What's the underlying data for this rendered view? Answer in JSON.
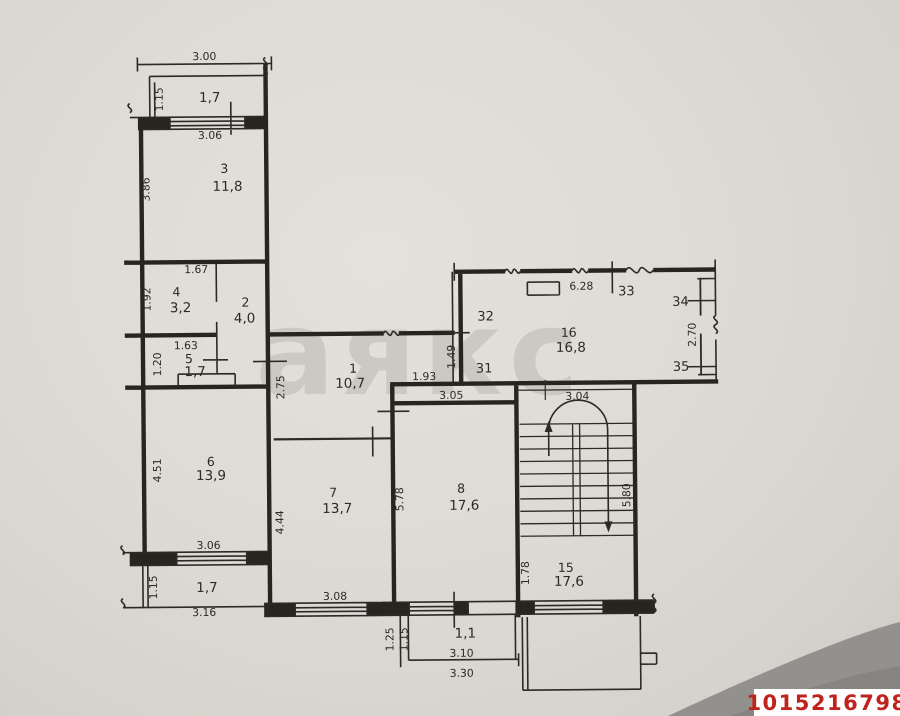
{
  "watermark": "аякс",
  "photo_id": "1015216798",
  "colors": {
    "paper": "#dedbd6",
    "ink": "#2b2a26",
    "id_red": "#c0221c",
    "shadow": "#8f8d8a",
    "watermark": "#ccc8c2"
  },
  "rooms": {
    "r1": {
      "num": "1",
      "area": "10,7"
    },
    "r2": {
      "num": "2",
      "area": "4,0"
    },
    "r3": {
      "num": "3",
      "area": "11,8"
    },
    "r4": {
      "num": "4",
      "area": "3,2"
    },
    "r5": {
      "num": "5",
      "area": "1,7"
    },
    "r6": {
      "num": "6",
      "area": "13,9"
    },
    "r7": {
      "num": "7",
      "area": "13,7"
    },
    "r8": {
      "num": "8",
      "area": "17,6"
    },
    "r15": {
      "num": "15",
      "area": "17,6"
    },
    "r16": {
      "num": "16",
      "area": "16,8"
    },
    "balcony_top": {
      "area": "1,7"
    },
    "balcony_left": {
      "area": "1,7"
    },
    "balcony_bottom": {
      "area": "1,1"
    }
  },
  "markers": {
    "m31": "31",
    "m32": "32",
    "m33": "33",
    "m34": "34",
    "m35": "35"
  },
  "dims": {
    "top_width": "3.00",
    "top_balcony_depth": "1.15",
    "top_window": "3.06",
    "room3_height": "3.86",
    "room4_width": "1.67",
    "room4_height": "1.92",
    "room5_window": "1.63",
    "room5_height": "1.20",
    "hall_height": "2.75",
    "room6_height": "4.51",
    "room6_window": "3.06",
    "left_balcony_depth": "1.15",
    "left_balcony_width": "3.16",
    "room7_height": "4.44",
    "room7_window": "3.08",
    "room7_width_dim": "1.93",
    "room8_width": "3.05",
    "room8_height": "5.78",
    "stair_width": "3.04",
    "stair_height": "5.80",
    "room15_depth": "1.78",
    "loggia_width": "6.28",
    "loggia_depth": "2.70",
    "shaft_height": "1.49",
    "bottom_balcony_d1": "1.25",
    "bottom_balcony_d2": "1.15",
    "bottom_balcony_w1": "3.10",
    "bottom_balcony_w2": "3.30"
  }
}
